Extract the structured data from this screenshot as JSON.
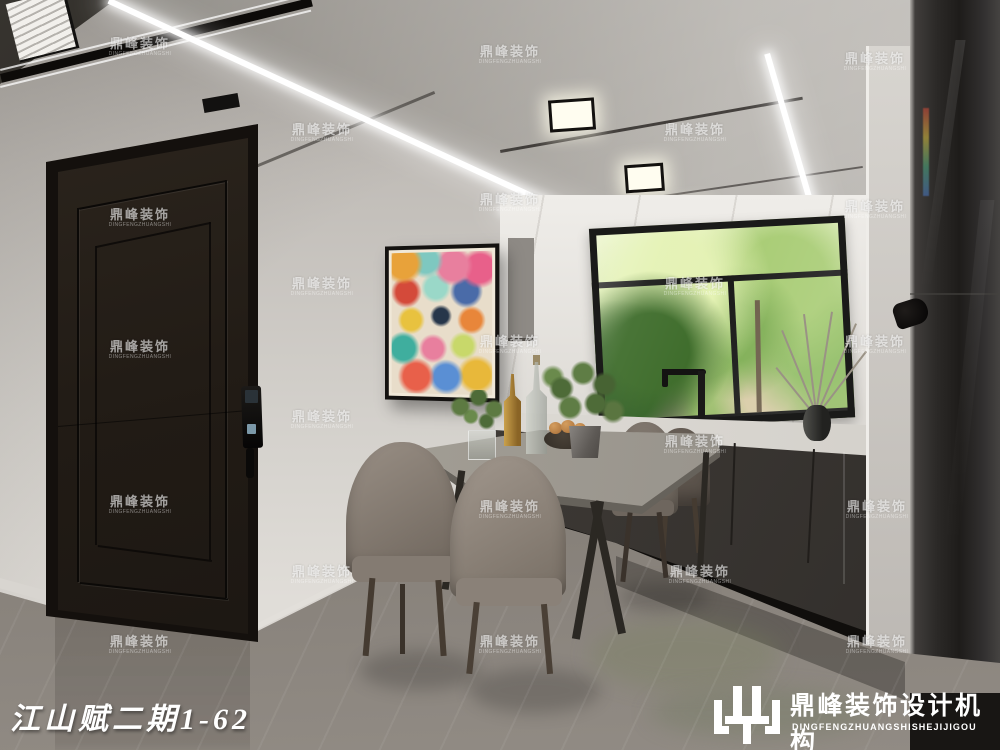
{
  "meta": {
    "caption": "江山赋二期1-62"
  },
  "watermark": {
    "text": "鼎峰装饰",
    "subtext": "DINGFENGZHUANGSHI",
    "positions": [
      [
        140,
        47
      ],
      [
        510,
        55
      ],
      [
        875,
        62
      ],
      [
        322,
        133
      ],
      [
        695,
        133
      ],
      [
        140,
        218
      ],
      [
        510,
        203
      ],
      [
        875,
        210
      ],
      [
        322,
        287
      ],
      [
        695,
        287
      ],
      [
        140,
        350
      ],
      [
        510,
        345
      ],
      [
        875,
        345
      ],
      [
        322,
        420
      ],
      [
        695,
        445
      ],
      [
        140,
        505
      ],
      [
        510,
        510
      ],
      [
        877,
        510
      ],
      [
        322,
        575
      ],
      [
        700,
        575
      ],
      [
        140,
        645
      ],
      [
        510,
        645
      ],
      [
        877,
        645
      ]
    ]
  },
  "logo": {
    "cn": "鼎峰装饰设计机构",
    "en": "DINGFENGZHUANGSHISHEJIJIGOU",
    "mark": "dingfeng-block-glyph"
  },
  "colors": {
    "wall": "#c6c2bd",
    "ceiling_gloss": "#99958f",
    "ceiling_dark_panel": "#191613",
    "door": "#211b15",
    "cabinet": "#3c3834",
    "counter": "#d8d5d0",
    "floor": "#958f88",
    "garden_green": "#7fae54",
    "window_frame": "#1a1a19",
    "chair_taupe": "#8a8078",
    "watermark_white": "#ffffff",
    "artwork_palette": [
      "#e87f9e",
      "#3fae9e",
      "#e8863a",
      "#e8c23f",
      "#5a8fd4",
      "#d44a3a",
      "#27364a",
      "#e8ddca"
    ]
  },
  "scene": {
    "objects": [
      "led-light-strips",
      "recessed-downlights",
      "ac-vent",
      "entry-door",
      "smart-door-lock",
      "doodle-artwork",
      "kitchen-window",
      "garden-view",
      "black-faucet",
      "kitchen-counter",
      "base-cabinets",
      "marble-backsplash",
      "refrigerator",
      "dining-table",
      "dining-chairs",
      "champagne-bottle",
      "glass-bottle",
      "fruit-bowl",
      "potted-plant",
      "dry-branch-vase",
      "marble-floor"
    ]
  }
}
